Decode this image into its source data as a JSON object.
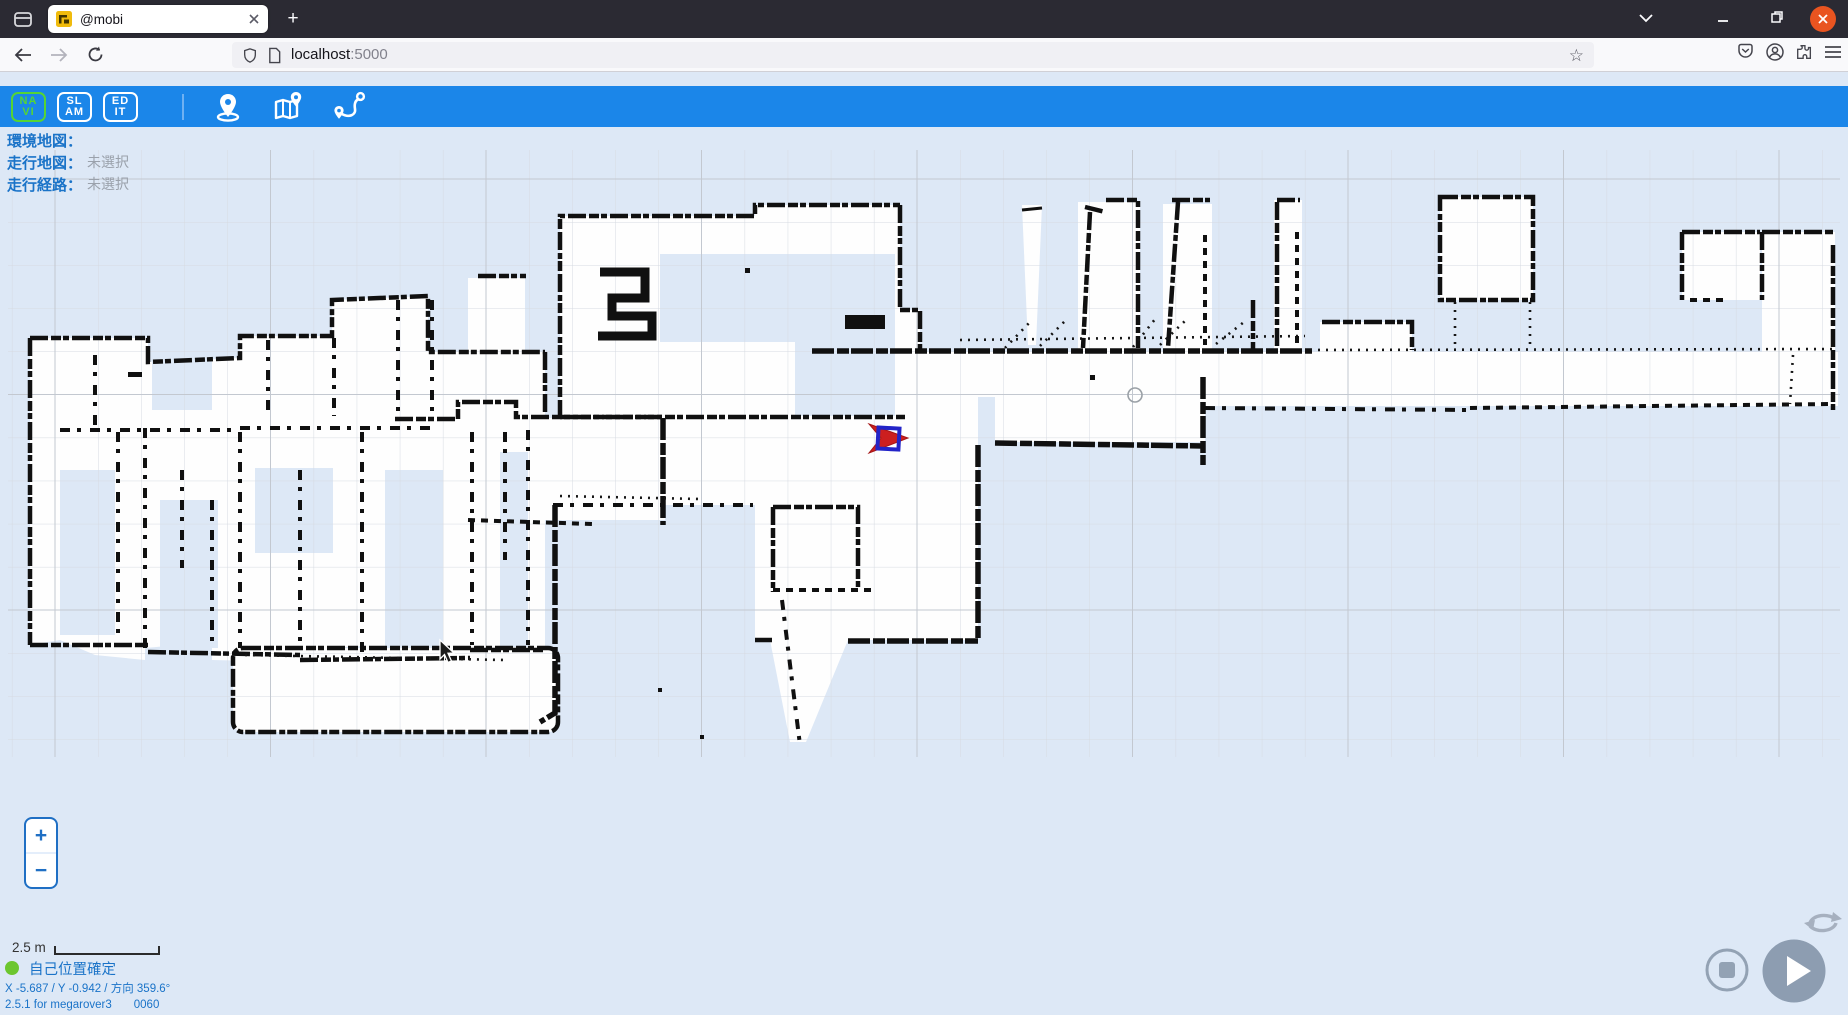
{
  "browser": {
    "tab_title": "@mobi",
    "new_tab_button": "+",
    "url_host": "localhost",
    "url_port": ":5000",
    "bookmark_star": "☆"
  },
  "toolbar": {
    "buttons": [
      {
        "id": "navi",
        "line1": "NA",
        "line2": "VI",
        "active": true
      },
      {
        "id": "slam",
        "line1": "SL",
        "line2": "AM",
        "active": false
      },
      {
        "id": "edit",
        "line1": "ED",
        "line2": "IT",
        "active": false
      }
    ],
    "icons": [
      "set-position-icon",
      "map-select-icon",
      "route-select-icon"
    ]
  },
  "panel": {
    "env_map_label": "環境地図：",
    "env_map_value": "",
    "drive_map_label": "走行地図：",
    "drive_map_value": "未選択",
    "route_label": "走行経路：",
    "route_value": "未選択"
  },
  "map": {
    "zoom_in": "+",
    "zoom_out": "−",
    "scale_label": "2.5 m"
  },
  "status": {
    "localization": "自己位置確定",
    "pose": "X -5.687 / Y -0.942 / 方向 359.6°",
    "version": "2.5.1 for megarover3",
    "version_code": "0060"
  },
  "colors": {
    "toolbar_blue": "#1b86e9",
    "active_green": "#55d435",
    "status_blue": "#1a73c8",
    "muted_gray": "#9aa1ab",
    "close_button_orange": "#E95420",
    "map_background": "#dde8f6",
    "control_gray": "#8d9db1",
    "robot_red": "#cc1f1f",
    "robot_square_blue": "#2324c8"
  }
}
